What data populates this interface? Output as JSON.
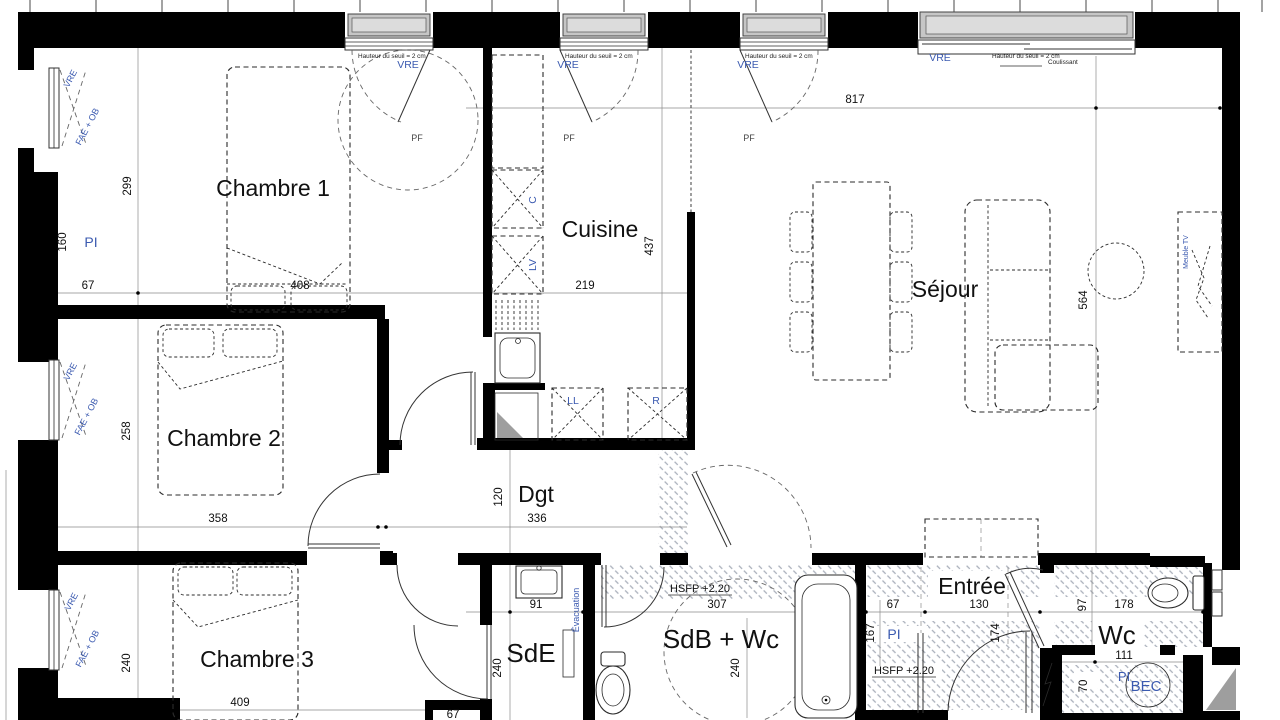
{
  "plan_type": "floor-plan",
  "rooms": {
    "chambre1": "Chambre 1",
    "chambre2": "Chambre 2",
    "chambre3": "Chambre 3",
    "cuisine": "Cuisine",
    "sejour": "Séjour",
    "dgt": "Dgt",
    "sde": "SdE",
    "sdb_wc": "SdB + Wc",
    "entree": "Entrée",
    "wc": "Wc"
  },
  "equipment": {
    "bec": "BEC",
    "pi": "PI",
    "c": "C",
    "lv": "LV",
    "ll": "LL",
    "r": "R",
    "evacuation": "Évacuation",
    "meuble_tv": "Meuble TV"
  },
  "windows": {
    "vre": "VRE",
    "pf": "PF",
    "fae_ob": "FAE + OB",
    "coulissant": "Coulissant",
    "seuil_note": "Hauteur du seuil = 2 cm"
  },
  "notes": {
    "hsfp": "HSFP +2.20"
  },
  "dims": {
    "d67": "67",
    "d70": "70",
    "d91": "91",
    "d97": "97",
    "d111": "111",
    "d120": "120",
    "d130": "130",
    "d160": "160",
    "d167": "167",
    "d174": "174",
    "d178": "178",
    "d219": "219",
    "d240": "240",
    "d258": "258",
    "d299": "299",
    "d307": "307",
    "d336": "336",
    "d358": "358",
    "d408": "408",
    "d409": "409",
    "d437": "437",
    "d564": "564",
    "d817": "817"
  },
  "colors": {
    "wall": "#000000",
    "annotation_blue": "#3b5ab0",
    "annotation_orange": "#c07a1e",
    "window_shade": "#c6c6c6",
    "hatch": "#aab0bb",
    "triangle_gray": "#9e9e9e"
  }
}
